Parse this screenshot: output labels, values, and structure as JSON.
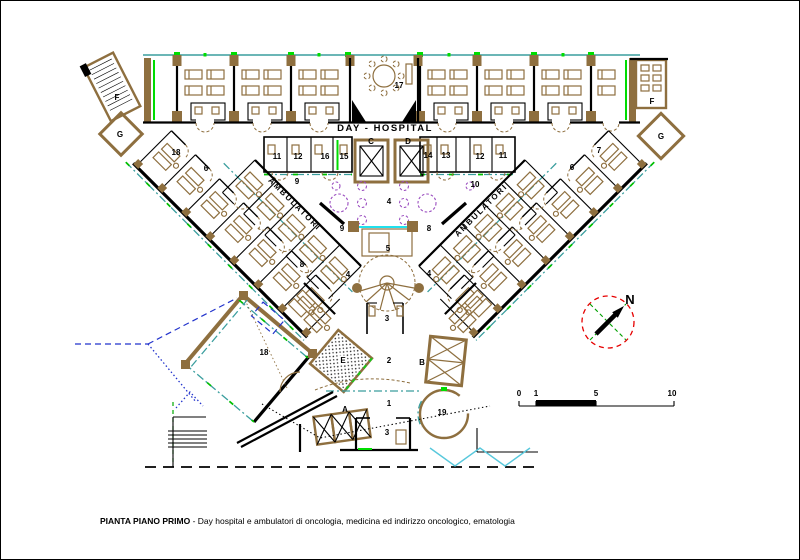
{
  "title": {
    "bold": "PIANTA PIANO PRIMO",
    "rest": " - Day hospital e ambulatori di oncologia, medicina ed indirizzo oncologico, ematologia"
  },
  "plan": {
    "wing_label": "DAY - HOSPITAL",
    "corridor_label": "AMBULATORI",
    "north_label": "N"
  },
  "scale_bar": {
    "ticks": [
      "0",
      "1",
      "5",
      "10"
    ]
  },
  "colors": {
    "wall": "#000000",
    "wood": "#8e6f3f",
    "teal": "#3a9e9e",
    "cyan": "#00dce9",
    "green": "#00c000",
    "purple": "#9b4fc0",
    "red": "#e60000",
    "blue": "#2233cc"
  },
  "rooms": [
    {
      "label": "F"
    },
    {
      "label": "G"
    },
    {
      "label": "17"
    },
    {
      "label": "F"
    },
    {
      "label": "G"
    },
    {
      "label": "18"
    },
    {
      "label": "6"
    },
    {
      "label": "11"
    },
    {
      "label": "12"
    },
    {
      "label": "16"
    },
    {
      "label": "15"
    },
    {
      "label": "C"
    },
    {
      "label": "D"
    },
    {
      "label": "14"
    },
    {
      "label": "13"
    },
    {
      "label": "12"
    },
    {
      "label": "11"
    },
    {
      "label": "6"
    },
    {
      "label": "7"
    },
    {
      "label": "9"
    },
    {
      "label": "10"
    },
    {
      "label": "4"
    },
    {
      "label": "9"
    },
    {
      "label": "8"
    },
    {
      "label": "5"
    },
    {
      "label": "8"
    },
    {
      "label": "4"
    },
    {
      "label": "4"
    },
    {
      "label": "3"
    },
    {
      "label": "E"
    },
    {
      "label": "2"
    },
    {
      "label": "B"
    },
    {
      "label": "A"
    },
    {
      "label": "1"
    },
    {
      "label": "19"
    },
    {
      "label": "3"
    },
    {
      "label": "18"
    }
  ]
}
